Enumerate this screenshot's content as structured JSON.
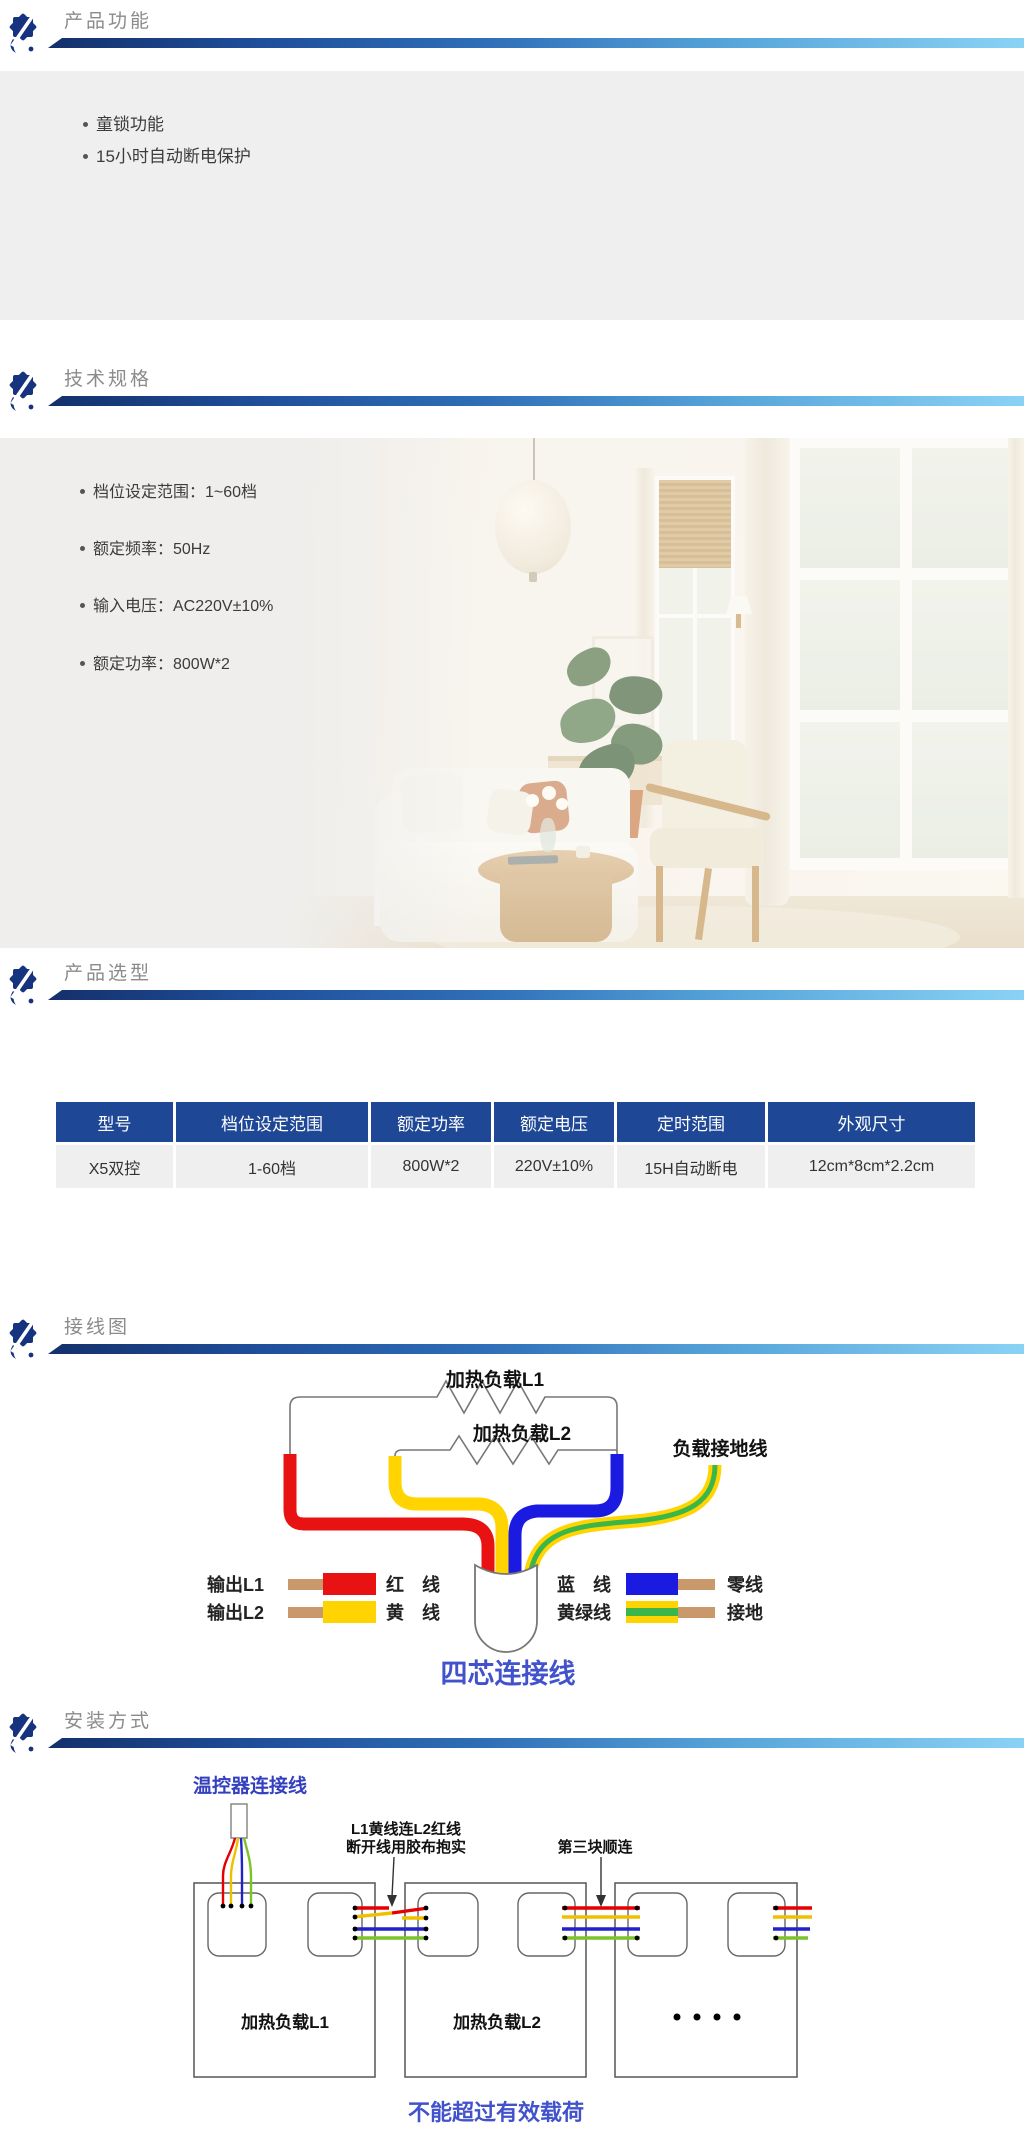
{
  "sections": {
    "features": {
      "title": "产品功能",
      "bullets": [
        "童锁功能",
        "15小时自动断电保护"
      ]
    },
    "specs": {
      "title": "技术规格",
      "bullets": [
        "档位设定范围：1~60档",
        "额定频率：50Hz",
        "输入电压：AC220V±10%",
        "额定功率：800W*2"
      ]
    },
    "selection": {
      "title": "产品选型",
      "table": {
        "headers": [
          "型号",
          "档位设定范围",
          "额定功率",
          "额定电压",
          "定时范围",
          "外观尺寸"
        ],
        "rows": [
          [
            "X5双控",
            "1-60档",
            "800W*2",
            "220V±10%",
            "15H自动断电",
            "12cm*8cm*2.2cm"
          ]
        ]
      }
    },
    "wiring": {
      "title": "接线图",
      "labels": {
        "load1": "加热负载L1",
        "load2": "加热负载L2",
        "ground": "负载接地线",
        "cable": "四芯连接线"
      },
      "legend": {
        "out1": "输出L1",
        "out2": "输出L2",
        "red": "红　线",
        "yellow": "黄　线",
        "blue": "蓝　线",
        "yellow_green": "黄绿线",
        "neutral": "零线",
        "earth": "接地"
      }
    },
    "install": {
      "title": "安装方式",
      "labels": {
        "thermostat": "温控器连接线",
        "note1_line1": "L1黄线连L2红线",
        "note1_line2": "断开线用胶布抱实",
        "note2": "第三块顺连",
        "load1": "加热负载L1",
        "load2": "加热负载L2",
        "warning": "不能超过有效载荷"
      }
    }
  },
  "colors": {
    "bar_gradient_start": "#14306b",
    "bar_gradient_end": "#8ad2f5",
    "section_title": "#8b8b8b",
    "table_header_bg": "#1e4796",
    "table_row_bg": "#efefef",
    "gray_panel_bg": "#efefef",
    "wire_red": "#e81212",
    "wire_yellow": "#ffd400",
    "wire_blue": "#1a1ae0",
    "wire_green": "#3cb549",
    "terminal_tan": "#c9996b",
    "diagram_blue_text": "#4152cc"
  }
}
